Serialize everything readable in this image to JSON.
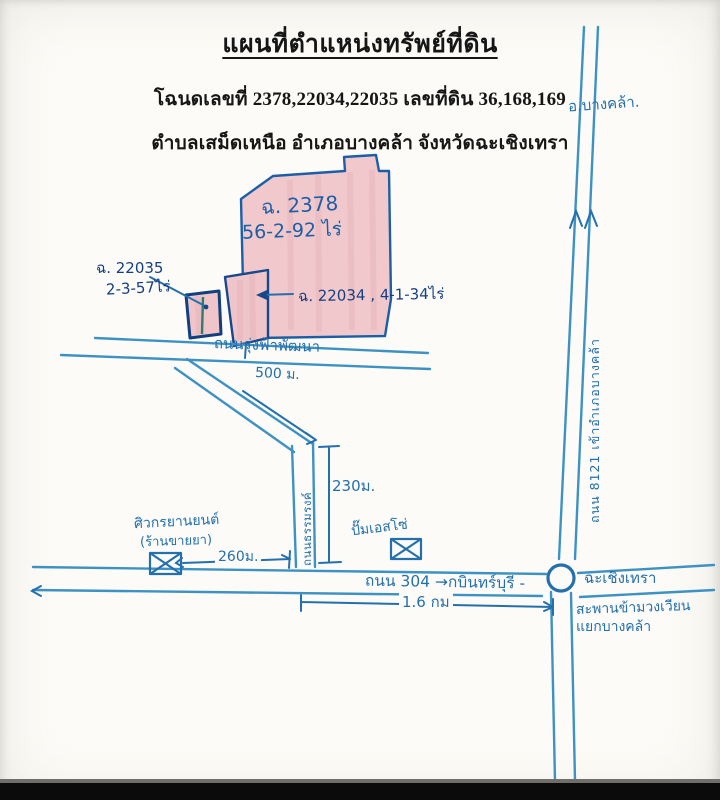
{
  "header": {
    "title": "แผนที่ตำแหน่งทรัพย์ที่ดิน",
    "deed_line": "โฉนดเลขที่ 2378,22034,22035 เลขที่ดิน 36,168,169",
    "location_line": "ตำบลเสม็ดเหนือ อำเภอบางคล้า จังหวัดฉะเชิงเทรา"
  },
  "plots": {
    "p2378": {
      "label": "ฉ. 2378",
      "area": "56-2-92 ไร่"
    },
    "p22034": {
      "label": "ฉ. 22034 , 4-1-34ไร่"
    },
    "p22035": {
      "label": "ฉ. 22035",
      "area": "2-3-57ไร่"
    }
  },
  "roads": {
    "rungfa": "ถนนรุ่งฟ้าพัฒนา",
    "side_road": "ถนนธรรมรงค์",
    "road304": "ถนน 304 →กบินทร์บุรี -",
    "road8121": "ถนน 8121 เข้าอำเภอบางคล้า"
  },
  "landmarks": {
    "district_arrow": "อ.บางคล้า.",
    "shop_name": "ศิวกรยานยนต์",
    "shop_note": "(ร้านขายยา)",
    "gas_station": "ปั๊มเอสโซ่",
    "chachoengsao": "ฉะเชิงเทรา",
    "bridge_line1": "สะพานข้ามวงเวียน",
    "bridge_line2": "แยกบางคล้า"
  },
  "measurements": {
    "to_plot_500": "500 ม.",
    "side_230": "230ม.",
    "shop_260": "260ม.",
    "hwy_16": "1.6 กม"
  },
  "colors": {
    "ink_blue": "#3e92c3",
    "ink_dark_blue": "#2470ad",
    "plot_outline": "#17488c",
    "plot_fill": "#f1c9cd",
    "marker_green": "#2e7d6e",
    "paper": "#fcfbf7",
    "printed_text": "#161616"
  }
}
